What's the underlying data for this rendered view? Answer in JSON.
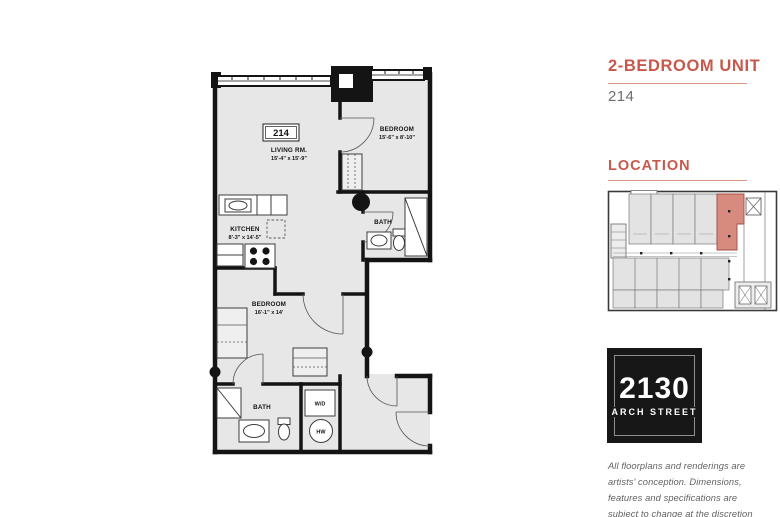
{
  "theme": {
    "accent": "#c8584b",
    "accent_light": "#dc9184",
    "map_highlight": "#d78b7f",
    "map_highlight_stroke": "#a44d41",
    "plan_fill": "#e7e7e7"
  },
  "header": {
    "title": "2-BEDROOM UNIT",
    "unit_number": "214"
  },
  "location": {
    "heading": "LOCATION"
  },
  "logo": {
    "address_number": "2130",
    "street": "ARCH STREET"
  },
  "disclaimer": {
    "text": "All floorplans and renderings are artists' conception. Dimensions, features and specifications are subject to change at the discretion of the builder."
  },
  "floorplan": {
    "unit_label": "214",
    "rooms": [
      {
        "name": "LIVING RM.",
        "dims": "15'-4\" x 15'-9\""
      },
      {
        "name": "BEDROOM",
        "dims": "15'-6\" x 8'-10\""
      },
      {
        "name": "KITCHEN",
        "dims": "8'-3\" x 14'-5\""
      },
      {
        "name": "BATH",
        "dims": ""
      },
      {
        "name": "BEDROOM",
        "dims": "16'-1\" x 14'"
      },
      {
        "name": "BATH",
        "dims": ""
      },
      {
        "name": "W/D",
        "dims": ""
      },
      {
        "name": "HW",
        "dims": ""
      }
    ]
  }
}
